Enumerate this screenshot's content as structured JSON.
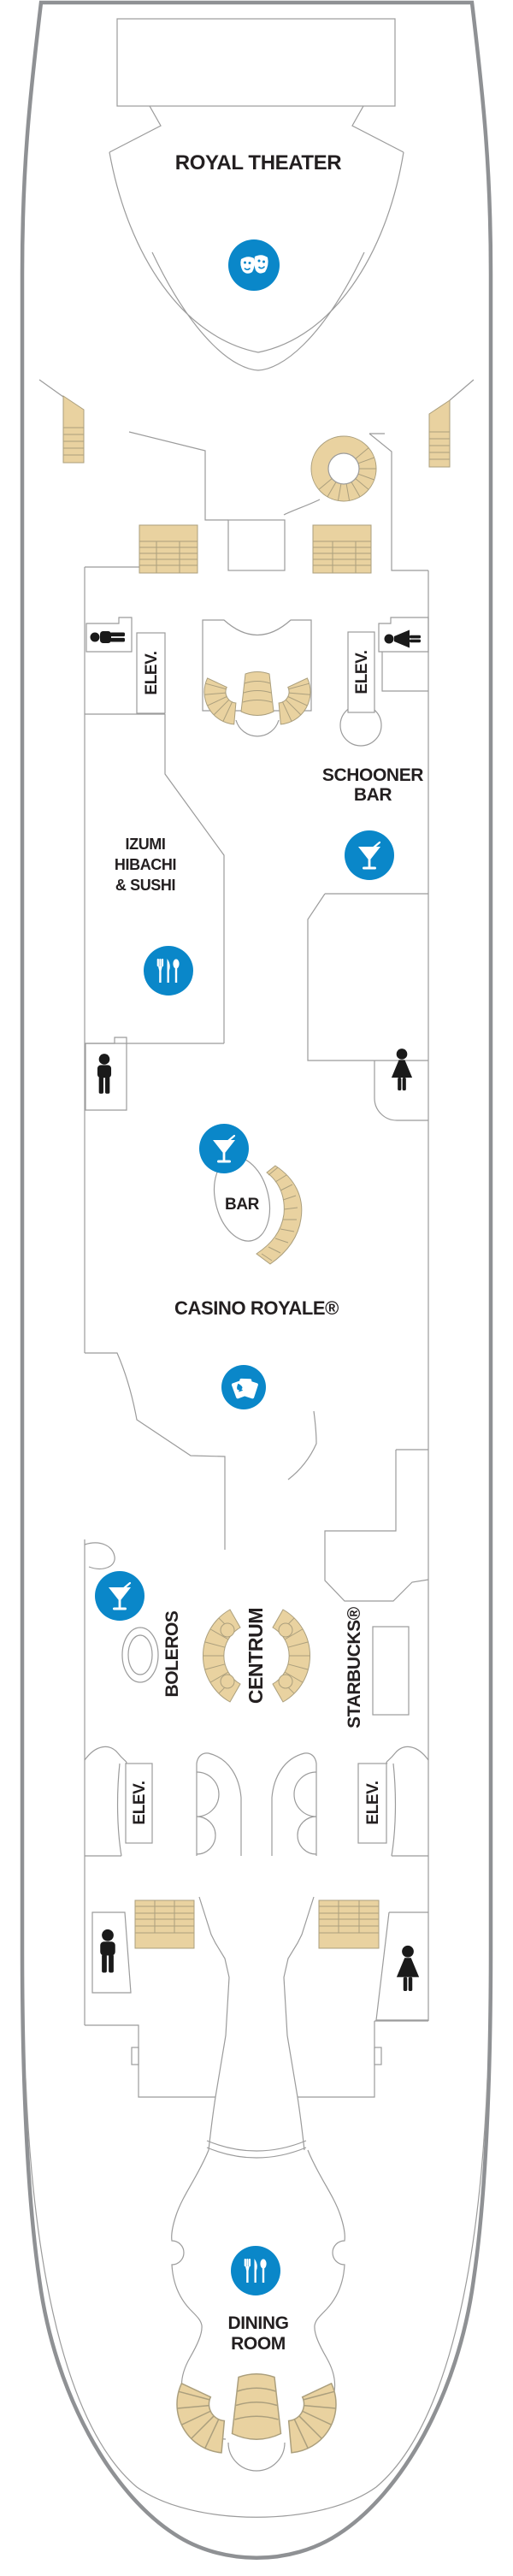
{
  "deck": {
    "labels": {
      "royal_theater": "ROYAL THEATER",
      "schooner_line1": "SCHOONER",
      "schooner_line2": "BAR",
      "izumi_line1": "IZUMI",
      "izumi_line2": "HIBACHI",
      "izumi_line3": "& SUSHI",
      "bar": "BAR",
      "casino": "CASINO ROYALE®",
      "boleros": "BOLEROS",
      "centrum": "CENTRUM",
      "starbucks": "STARBUCKS®",
      "dining_line1": "DINING",
      "dining_line2": "ROOM",
      "elev": "ELEV."
    },
    "icons": {
      "theater_masks": "theater-masks-icon",
      "martini": "martini-icon",
      "dining_utensils": "dining-utensils-icon",
      "casino_cards": "casino-cards-icon",
      "men_restroom": "men-restroom-icon",
      "women_restroom": "women-restroom-icon"
    },
    "colors": {
      "icon_blue": "#0a87c9",
      "stair_tan": "#e9d2a0",
      "stair_tan_stroke": "#ab9f7d",
      "wall_gray": "#9b9b9b",
      "hull_gray": "#8f9194",
      "text_black": "#231f20"
    }
  }
}
